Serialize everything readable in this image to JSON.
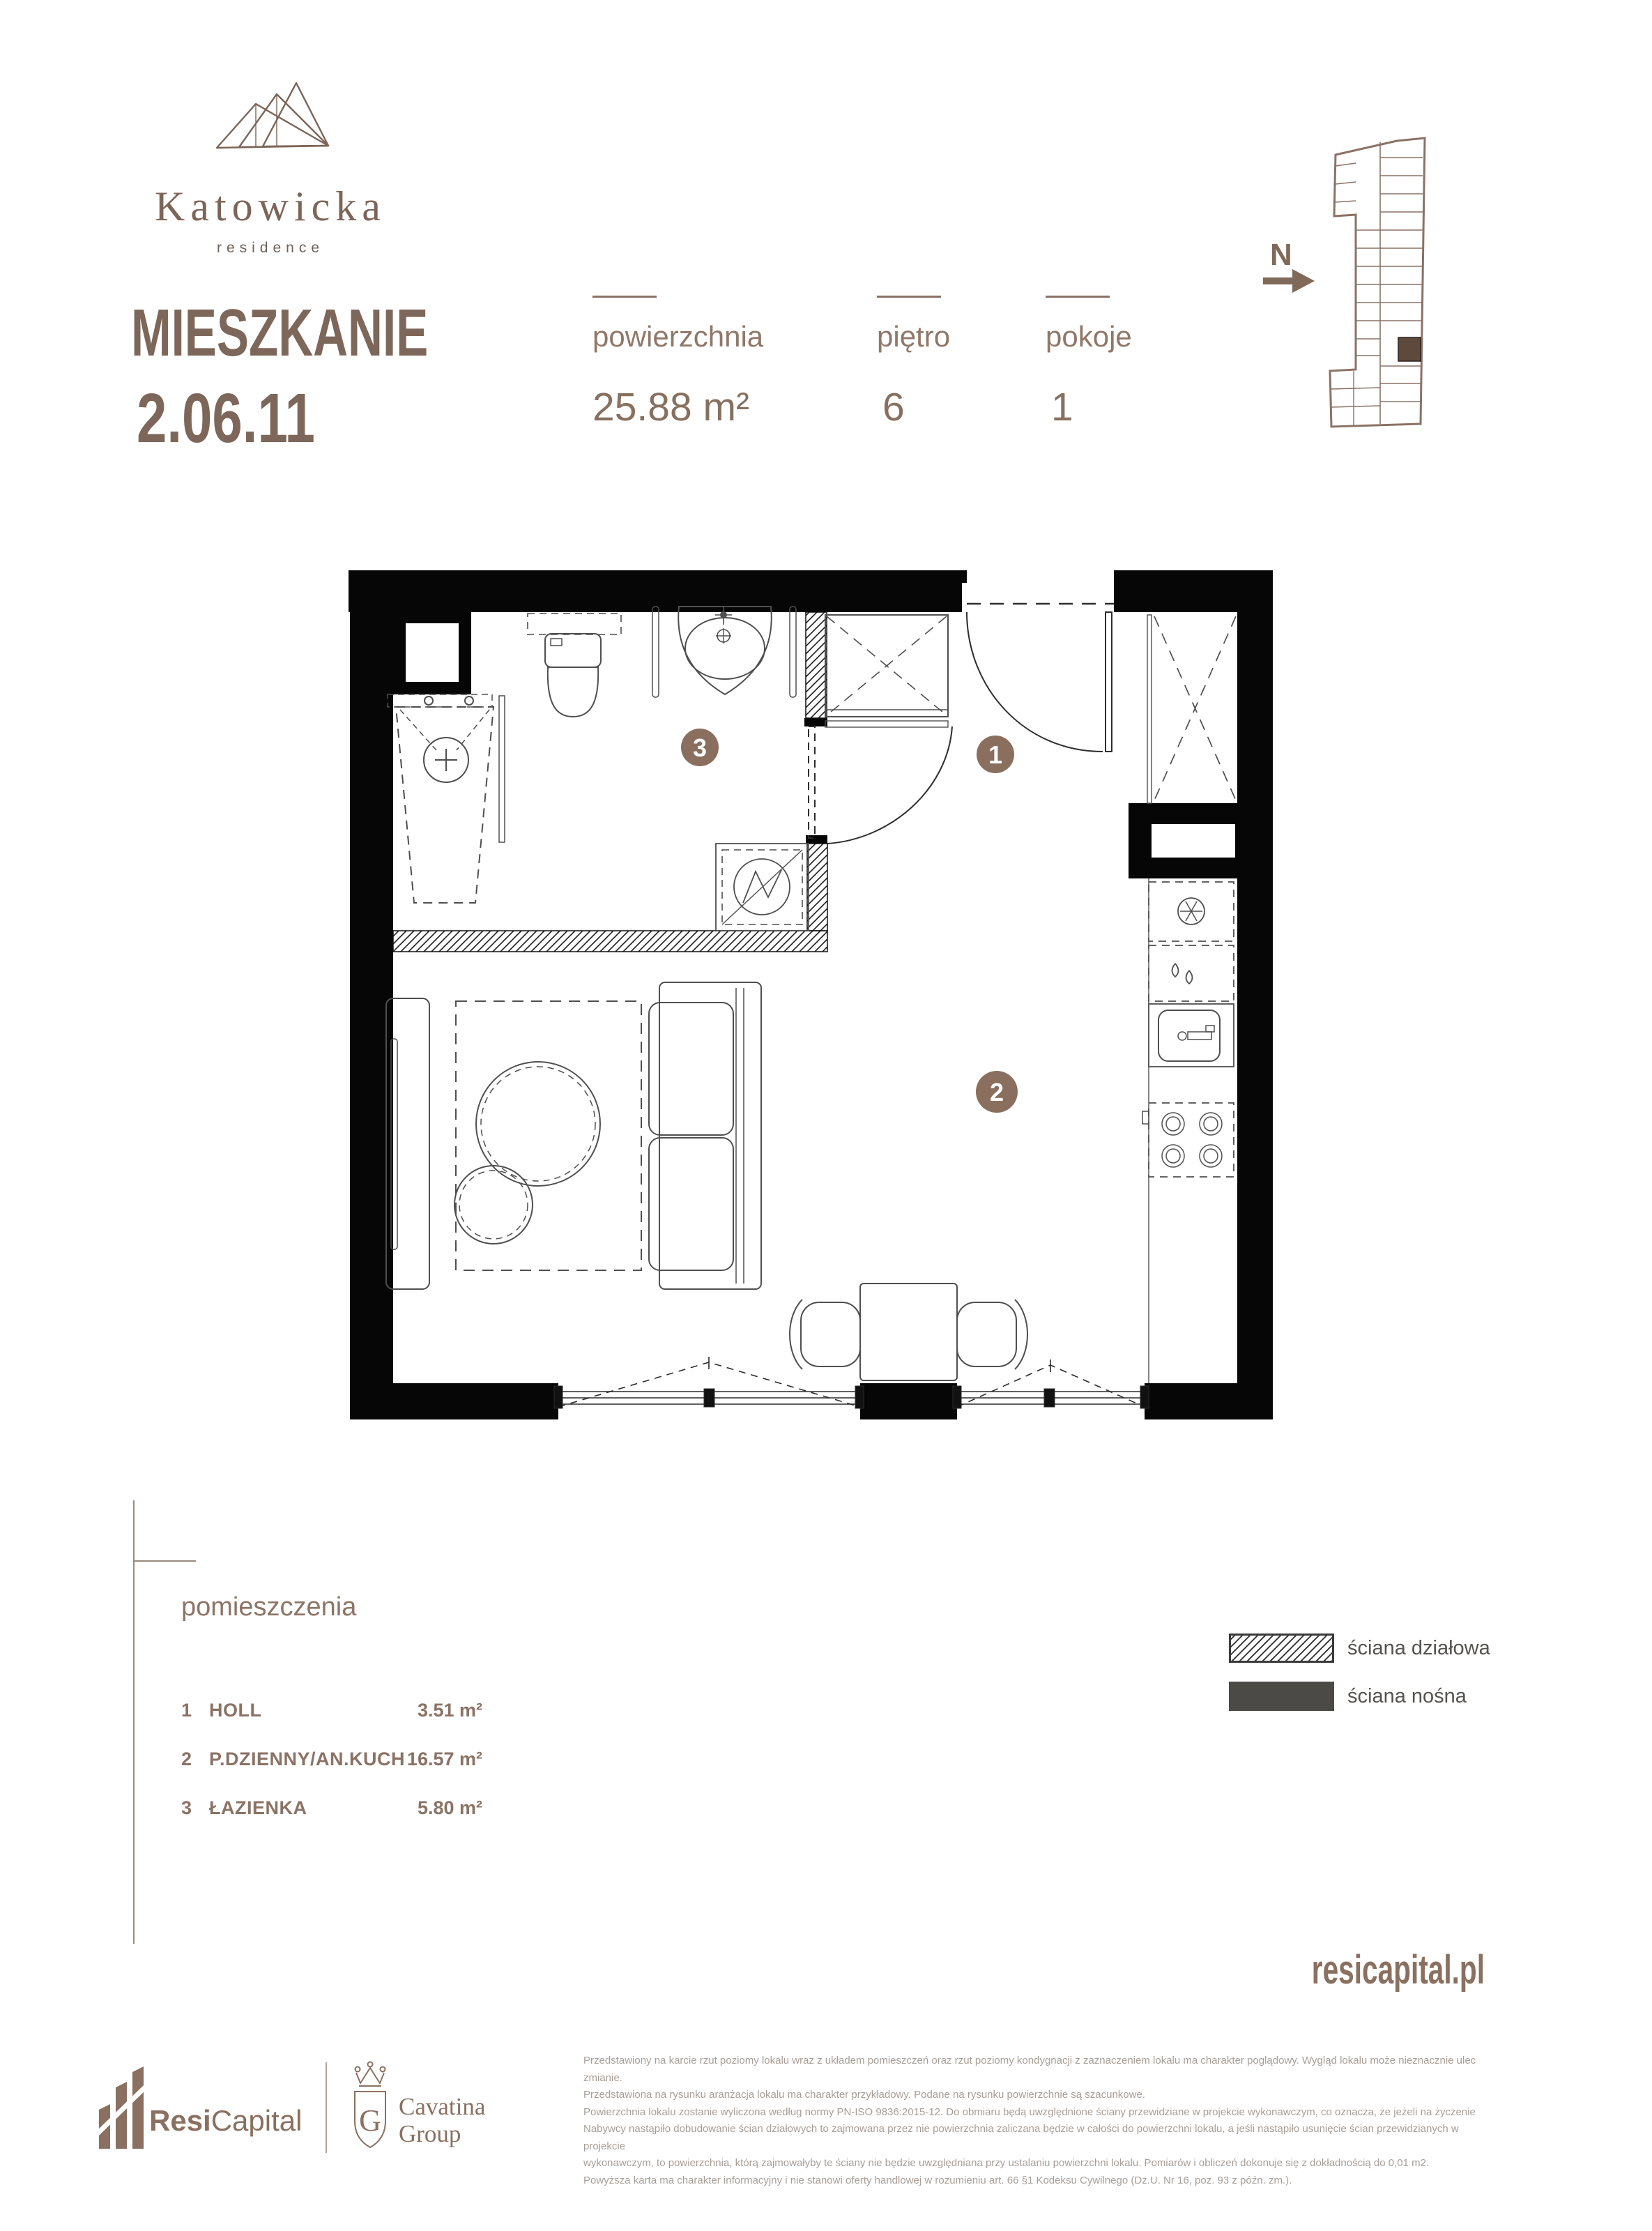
{
  "brand": {
    "name": "Katowicka",
    "subtitle": "residence",
    "website": "resicapital.pl"
  },
  "header": {
    "title": "MIESZKANIE",
    "unit": "2.06.11",
    "stats": [
      {
        "label": "powierzchnia",
        "value": "25.88 m²"
      },
      {
        "label": "piętro",
        "value": "6"
      },
      {
        "label": "pokoje",
        "value": "1"
      }
    ]
  },
  "minimap": {
    "north_label": "N"
  },
  "rooms": {
    "heading": "pomieszczenia",
    "items": [
      {
        "id": "1",
        "name": "HOLL",
        "area": "3.51 m²"
      },
      {
        "id": "2",
        "name": "P.DZIENNY/AN.KUCH",
        "area": "16.57 m²"
      },
      {
        "id": "3",
        "name": "ŁAZIENKA",
        "area": "5.80 m²"
      }
    ]
  },
  "wall_legend": {
    "partition": "ściana działowa",
    "load_bearing": "ściana nośna"
  },
  "footer": {
    "resi_bold": "Resi",
    "resi_light": "Capital",
    "cavatina_initial": "G",
    "cavatina_line1": "Cavatina",
    "cavatina_line2": "Group",
    "disclaimer": [
      "Przedstawiony na karcie rzut poziomy lokalu wraz z układem pomieszczeń oraz rzut poziomy kondygnacji z zaznaczeniem lokalu ma charakter poglądowy. Wygląd lokalu może nieznacznie ulec zmianie.",
      "Przedstawiona na rysunku aranżacja lokalu ma charakter przykładowy. Podane na rysunku powierzchnie są szacunkowe.",
      "Powierzchnia lokalu zostanie wyliczona według normy PN-ISO 9836:2015-12. Do obmiaru będą uwzględnione ściany przewidziane w projekcie wykonawczym, co oznacza, że jeżeli na życzenie",
      "Nabywcy nastąpiło dobudowanie ścian działowych to zajmowana przez nie powierzchnia zaliczana będzie w całości do powierzchni lokalu, a jeśli nastąpiło usunięcie ścian przewidzianych w projekcie",
      "wykonawczym, to powierzchnia, którą zajmowałyby te ściany nie będzie uwzględniana przy ustalaniu powierzchni lokalu. Pomiarów i obliczeń dokonuje się z dokładnością do 0,01 m2.",
      "Powyższa karta ma charakter informacyjny i nie stanowi oferty handlowej w rozumieniu art. 66 §1 Kodeksu Cywilnego (Dz.U. Nr 16, poz. 93 z późn. zm.)."
    ]
  },
  "colors": {
    "accent": "#8a6f5e",
    "heading": "#7d675a",
    "map_stroke": "#8a7265",
    "legend_text": "#55534f",
    "load_bearing_fill": "#4b4a47",
    "fineprint": "#a89e97"
  }
}
